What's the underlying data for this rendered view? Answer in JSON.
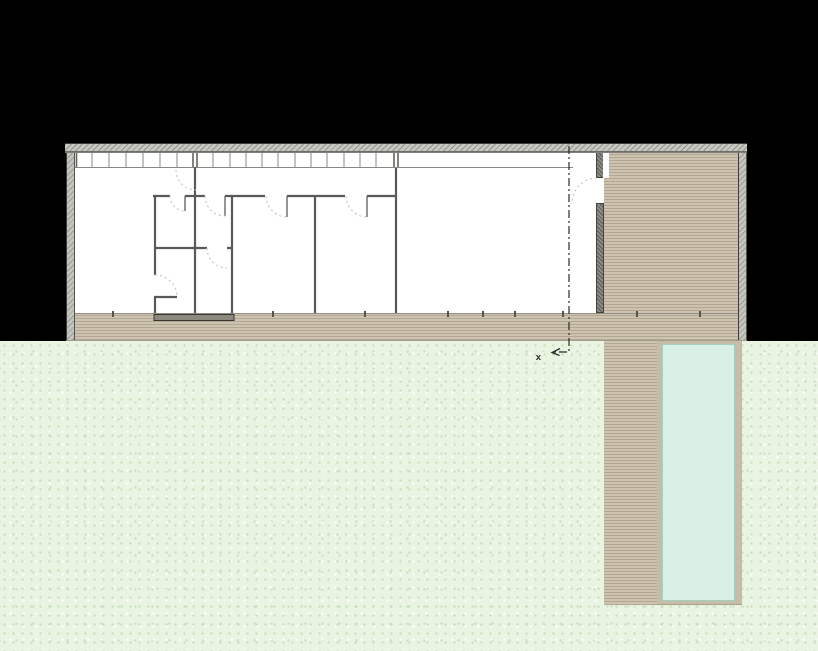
{
  "meta": {
    "drawing_type": "architectural floor plan",
    "description": "Single-storey house plan on black background with window mullion band, interior rooms with door swings, timber deck courtyard, lap pool and speckled lawn"
  },
  "annotations": {
    "section_label": "x"
  },
  "regions": {
    "background": "paper-black",
    "lawn": "speckled lawn field",
    "building": "house footprint with hatched perimeter walls",
    "window_band": "north facade mullioned glazing strip",
    "interior": "white room floors with partition walls and door swings",
    "courtyard": "timber deck court inside footprint (east end)",
    "deck_band": "timber deck verandah along south edge",
    "deck_strip": "timber boardwalk beside pool",
    "pool": "lap pool with coping",
    "section_marker": "dash-dot section line with arrow and label x",
    "threshold": "entry step plate on deck edge"
  },
  "colors": {
    "background": "#000000",
    "lawn": "#eaf4e3",
    "deck": "#c3b9a4",
    "deck_stripe_light": "#cdc3ae",
    "deck_stripe_dark": "#b1a792",
    "pool_water": "#d9f0e7",
    "pool_coping": "#c6bca7",
    "outer_wall": "#c8c8c2",
    "dividing_wall": "#8f8d88",
    "interior_wall": "#5b5955",
    "door_arc": "#c8c6c0",
    "section_line": "#2a2a28",
    "floor": "#ffffff"
  }
}
